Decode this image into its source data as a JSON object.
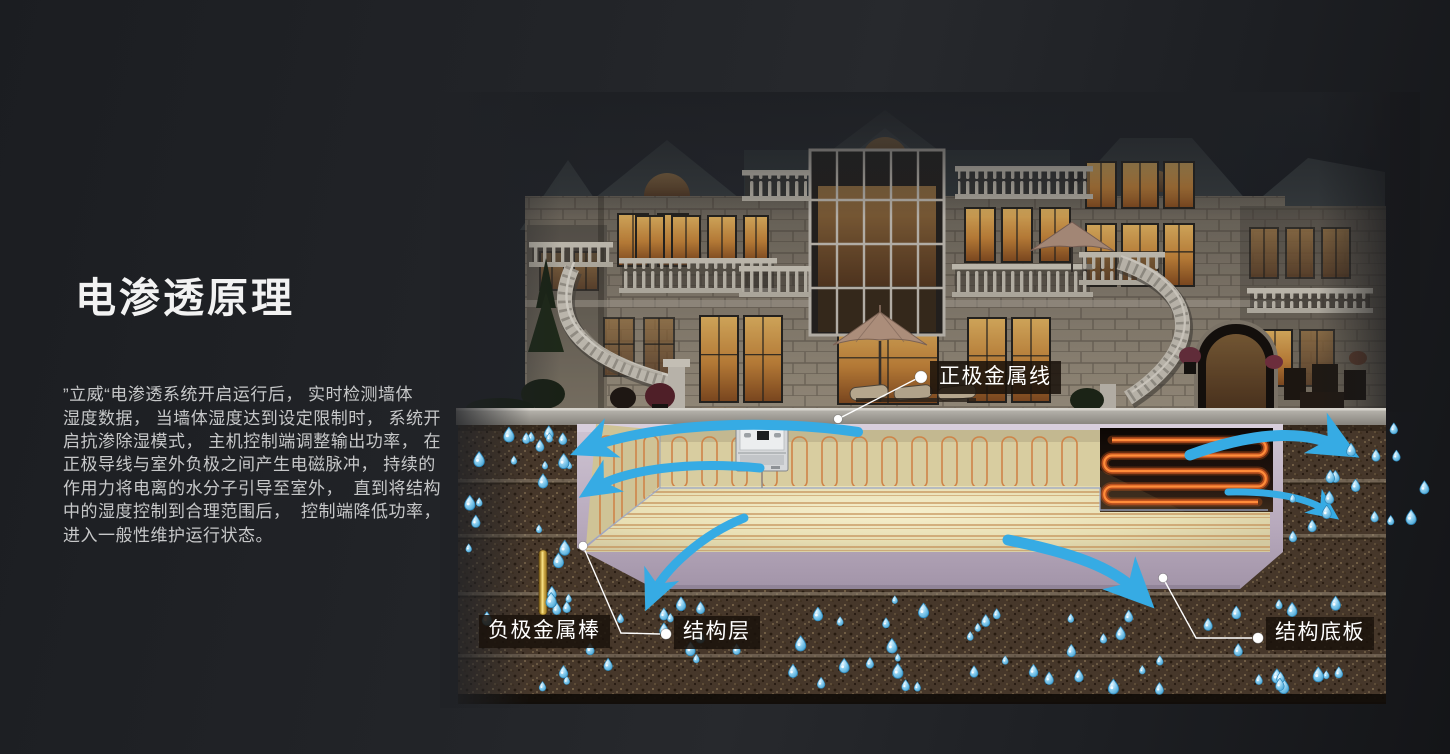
{
  "page": {
    "title": "电渗透原理"
  },
  "intro": {
    "lines": [
      "”立威“电渗透系统开启运行后， 实时检测墙体",
      "湿度数据， 当墙体湿度达到设定限制时， 系统开",
      "启抗渗除湿模式， 主机控制端调整输出功率， 在",
      "正极导线与室外负极之间产生电磁脉冲， 持续的",
      "作用力将电离的水分子引导至室外，  直到将结构",
      "中的湿度控制到合理范围后，  控制端降低功率，",
      "进入一般性维护运行状态。"
    ]
  },
  "diagram": {
    "labels": {
      "positive_wire": "正极金属线",
      "negative_rod": "负极金属棒",
      "structure_layer": "结构层",
      "structure_slab": "结构底板"
    }
  },
  "colors": {
    "accent_blue": "#36ABE4",
    "copper_wire": "#CF8448",
    "electrode_gold": "#D4AB3C",
    "concrete_lavender": "#BDAFC4",
    "soil_brown": "#4A3929",
    "label_background": "#211910",
    "title_text": "#F2F2F2",
    "body_text": "#C9CACB"
  }
}
